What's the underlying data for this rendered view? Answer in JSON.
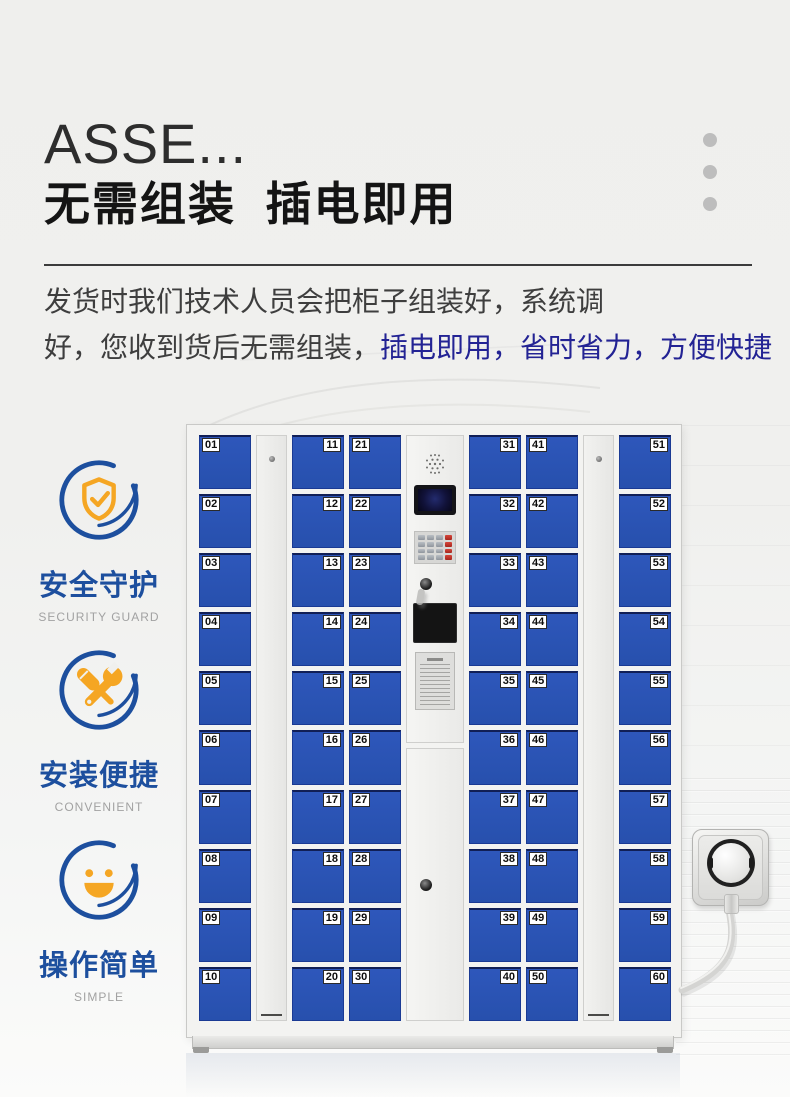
{
  "header": {
    "title": "ASSE...",
    "subtitle": "无需组装  插电即用",
    "dots_count": 3
  },
  "description": {
    "line1": "发货时我们技术人员会把柜子组装好，系统调",
    "line2_dark": "好，您收到货后无需组装，",
    "line2_highlight": "插电即用，省时省力，方便快捷"
  },
  "features": [
    {
      "icon": "shield-check-icon",
      "title": "安全守护",
      "subtitle": "SECURITY GUARD"
    },
    {
      "icon": "tools-icon",
      "title": "安装便捷",
      "subtitle": "CONVENIENT"
    },
    {
      "icon": "smiley-icon",
      "title": "操作简单",
      "subtitle": "SIMPLE"
    }
  ],
  "locker": {
    "columns": [
      {
        "type": "doors",
        "label_side": "left",
        "numbers": [
          "01",
          "02",
          "03",
          "04",
          "05",
          "06",
          "07",
          "08",
          "09",
          "10"
        ]
      },
      {
        "type": "panel"
      },
      {
        "type": "doors",
        "label_side": "right",
        "numbers": [
          "11",
          "12",
          "13",
          "14",
          "15",
          "16",
          "17",
          "18",
          "19",
          "20"
        ]
      },
      {
        "type": "doors",
        "label_side": "left",
        "numbers": [
          "21",
          "22",
          "23",
          "24",
          "25",
          "26",
          "27",
          "28",
          "29",
          "30"
        ]
      },
      {
        "type": "control"
      },
      {
        "type": "doors",
        "label_side": "right",
        "numbers": [
          "31",
          "32",
          "33",
          "34",
          "35",
          "36",
          "37",
          "38",
          "39",
          "40"
        ]
      },
      {
        "type": "doors",
        "label_side": "left",
        "numbers": [
          "41",
          "42",
          "43",
          "44",
          "45",
          "46",
          "47",
          "48",
          "49",
          "50"
        ]
      },
      {
        "type": "panel"
      },
      {
        "type": "doors",
        "label_side": "right",
        "numbers": [
          "51",
          "52",
          "53",
          "54",
          "55",
          "56",
          "57",
          "58",
          "59",
          "60"
        ]
      }
    ],
    "control": {
      "components": [
        "speaker-grille",
        "lcd-screen",
        "keypad",
        "keyhole",
        "scanner-screen",
        "notice-label"
      ],
      "keypad": {
        "rows": 4,
        "cols": 4,
        "red_column": 3
      }
    }
  },
  "colors": {
    "door_blue": "#2a53b7",
    "accent_blue": "#1d4f9e",
    "icon_orange": "#f5a623",
    "highlight_text_blue": "#232394",
    "dot_gray": "#bdbdbd"
  }
}
